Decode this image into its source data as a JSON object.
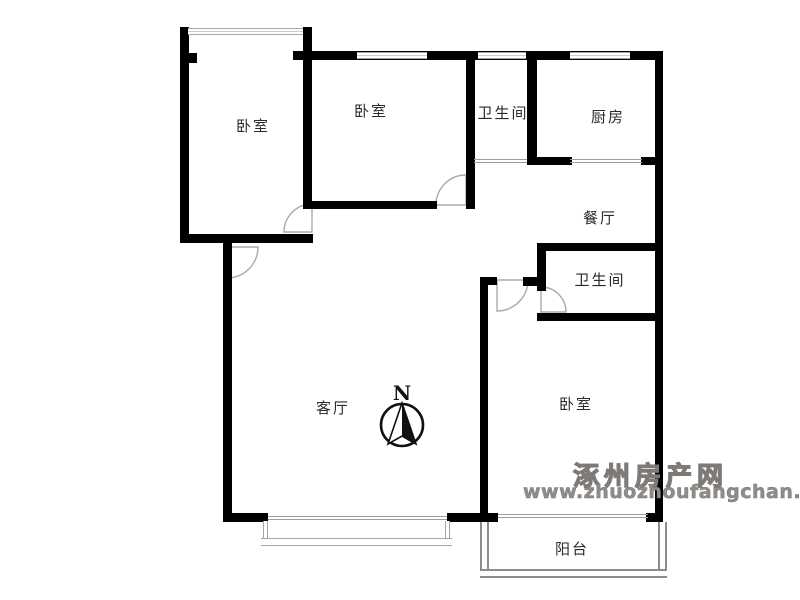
{
  "plan": {
    "type": "apartment-floor-plan",
    "rooms": {
      "bedroom_left": {
        "label": "卧室"
      },
      "bedroom_mid": {
        "label": "卧室"
      },
      "bath_top": {
        "label": "卫生间"
      },
      "kitchen": {
        "label": "厨房"
      },
      "dining": {
        "label": "餐厅"
      },
      "bath_mid": {
        "label": "卫生间"
      },
      "living": {
        "label": "客厅"
      },
      "bedroom_right": {
        "label": "卧室"
      },
      "balcony": {
        "label": "阳台"
      }
    }
  },
  "compass": {
    "north_label": "N"
  },
  "watermark": {
    "site_name": "涿州房产网",
    "site_url": "www.zhuozhoufangchan.com"
  },
  "colors": {
    "wall": "#000000",
    "window_line": "#a8a8a8",
    "door_arc": "#aaaaaa",
    "balcony_rail": "#8c8c8c",
    "watermark_gray": "#8f8c8a",
    "background": "#ffffff"
  }
}
